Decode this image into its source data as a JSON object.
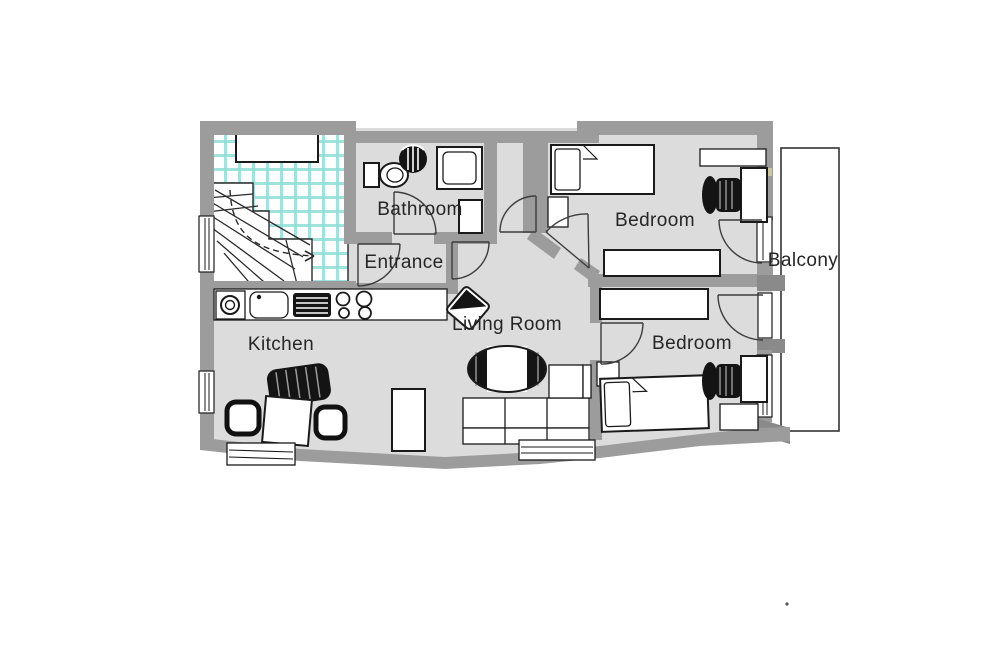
{
  "colors": {
    "wall": "#9c9c9c",
    "wall_dark": "#8a8a8a",
    "floor": "#dcdcdc",
    "tile": "#8fded6",
    "dark_furniture": "#141414",
    "sill_tan": "#cfc59f"
  },
  "floor_plan": {
    "rooms": [
      {
        "id": "bathroom",
        "label": "Bathroom"
      },
      {
        "id": "entrance",
        "label": "Entrance"
      },
      {
        "id": "bedroom-top",
        "label": "Bedroom"
      },
      {
        "id": "balcony",
        "label": "Balcony"
      },
      {
        "id": "kitchen",
        "label": "Kitchen"
      },
      {
        "id": "living-room",
        "label": "Living Room"
      },
      {
        "id": "bedroom-bottom",
        "label": "Bedroom"
      }
    ]
  }
}
